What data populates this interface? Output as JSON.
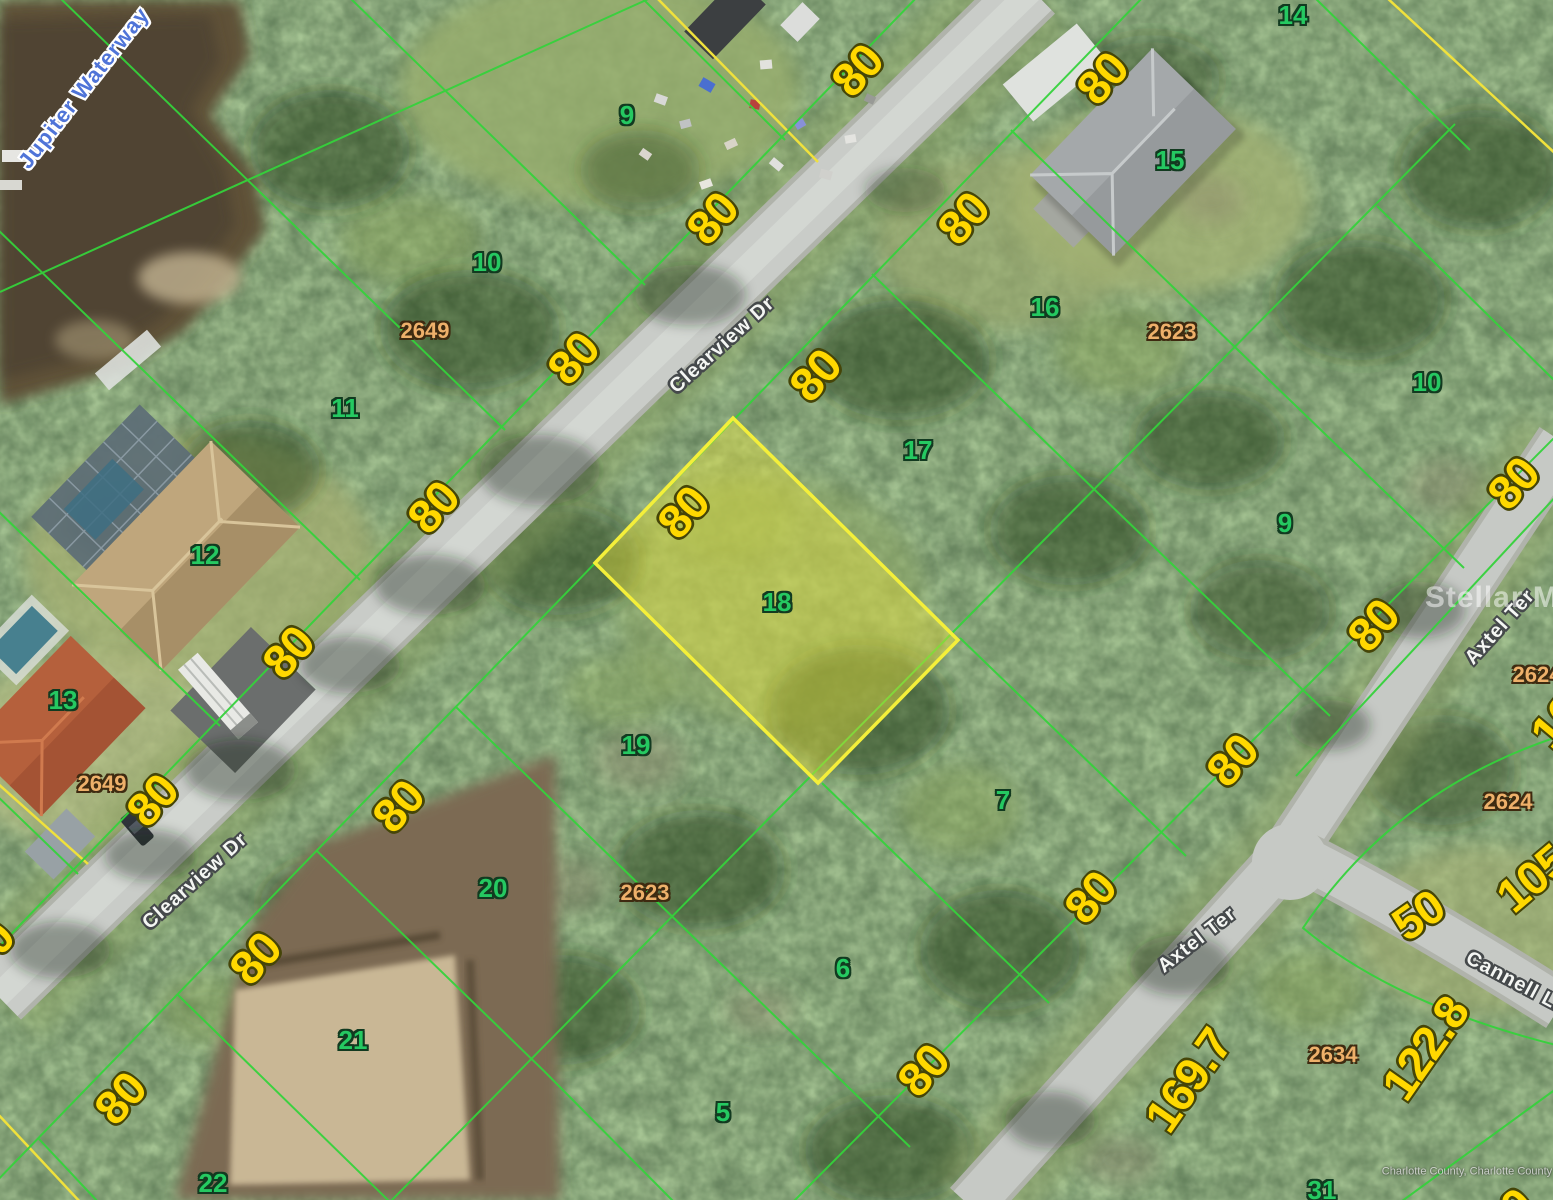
{
  "map": {
    "type": "aerial-parcel-map",
    "waterway": "Jupiter Waterway",
    "streets": [
      "Clearview Dr",
      "Axtel Ter",
      "Cannell Ln"
    ],
    "highlighted_lot": "18",
    "highlighted_lot_frontage_ft": "80",
    "lot_numbers": [
      "5",
      "6",
      "7",
      "9",
      "10",
      "11",
      "12",
      "13",
      "14",
      "15",
      "16",
      "17",
      "18",
      "19",
      "20",
      "21",
      "22",
      "31"
    ],
    "parcel_ids": [
      "2623",
      "2624",
      "2634",
      "2649"
    ],
    "dimensions_ft": [
      "80",
      "50",
      "105",
      "122.8",
      "169.7",
      "16"
    ],
    "watermark": "Stellar MLS",
    "attribution": "Charlotte County, Charlotte County GIS",
    "colors": {
      "parcel_line": "#35d23c",
      "plat_line": "#f0e13c",
      "highlight_fill": "rgba(235,228,60,0.42)",
      "highlight_stroke": "#f4ef3a",
      "dimension_text": "#ffd800",
      "lot_text": "#25c961",
      "parcel_id_text": "#eeb06a",
      "street_text": "#f2f4f3",
      "water_text": "#4f74d8"
    }
  },
  "labels": [
    {
      "cls": "water",
      "text": "Jupiter Waterway",
      "x": 84,
      "y": 88,
      "rot": -52
    },
    {
      "cls": "dim",
      "text": "80",
      "x": 857,
      "y": 70,
      "rot": -48
    },
    {
      "cls": "dim",
      "text": "80",
      "x": 1102,
      "y": 78,
      "rot": -48
    },
    {
      "cls": "dim",
      "text": "80",
      "x": 712,
      "y": 218,
      "rot": -48
    },
    {
      "cls": "dim",
      "text": "80",
      "x": 963,
      "y": 218,
      "rot": -48
    },
    {
      "cls": "dim",
      "text": "80",
      "x": 573,
      "y": 358,
      "rot": -48
    },
    {
      "cls": "dim",
      "text": "80",
      "x": 815,
      "y": 375,
      "rot": -48
    },
    {
      "cls": "dim",
      "text": "80",
      "x": 433,
      "y": 507,
      "rot": -48
    },
    {
      "cls": "dim",
      "text": "80",
      "x": 683,
      "y": 512,
      "rot": -48
    },
    {
      "cls": "dim",
      "text": "80",
      "x": 1513,
      "y": 483,
      "rot": -48
    },
    {
      "cls": "dim",
      "text": "80",
      "x": 1373,
      "y": 625,
      "rot": -48
    },
    {
      "cls": "dim",
      "text": "80",
      "x": 288,
      "y": 652,
      "rot": -48
    },
    {
      "cls": "dim",
      "text": "80",
      "x": 152,
      "y": 800,
      "rot": -48
    },
    {
      "cls": "dim",
      "text": "80",
      "x": 398,
      "y": 806,
      "rot": -48
    },
    {
      "cls": "dim",
      "text": "80",
      "x": 1232,
      "y": 760,
      "rot": -48
    },
    {
      "cls": "dim",
      "text": "80",
      "x": 255,
      "y": 958,
      "rot": -48
    },
    {
      "cls": "dim",
      "text": "80",
      "x": -12,
      "y": 947,
      "rot": -48
    },
    {
      "cls": "dim",
      "text": "80",
      "x": 120,
      "y": 1098,
      "rot": -48
    },
    {
      "cls": "dim",
      "text": "80",
      "x": 923,
      "y": 1070,
      "rot": -48
    },
    {
      "cls": "dim",
      "text": "80",
      "x": 1090,
      "y": 897,
      "rot": -48
    },
    {
      "cls": "dim",
      "text": "50",
      "x": 1418,
      "y": 915,
      "rot": -35
    },
    {
      "cls": "dim",
      "text": "105",
      "x": 1532,
      "y": 878,
      "rot": -40
    },
    {
      "cls": "dim",
      "text": "122.8",
      "x": 1425,
      "y": 1048,
      "rot": -55
    },
    {
      "cls": "dim",
      "text": "169.7",
      "x": 1188,
      "y": 1080,
      "rot": -55
    },
    {
      "cls": "dim",
      "text": "16",
      "x": 1556,
      "y": 722,
      "rot": -50
    },
    {
      "cls": "dim",
      "text": "80",
      "x": 1507,
      "y": 1214,
      "rot": -40
    },
    {
      "cls": "lot",
      "text": "9",
      "x": 627,
      "y": 115,
      "rot": 0
    },
    {
      "cls": "lot",
      "text": "10",
      "x": 487,
      "y": 262,
      "rot": 0
    },
    {
      "cls": "lot",
      "text": "11",
      "x": 345,
      "y": 408,
      "rot": 0
    },
    {
      "cls": "lot",
      "text": "12",
      "x": 205,
      "y": 555,
      "rot": 0
    },
    {
      "cls": "lot",
      "text": "13",
      "x": 63,
      "y": 700,
      "rot": 0
    },
    {
      "cls": "lot",
      "text": "14",
      "x": 1293,
      "y": 15,
      "rot": 0
    },
    {
      "cls": "lot",
      "text": "15",
      "x": 1170,
      "y": 160,
      "rot": 0
    },
    {
      "cls": "lot",
      "text": "16",
      "x": 1045,
      "y": 307,
      "rot": 0
    },
    {
      "cls": "lot",
      "text": "17",
      "x": 918,
      "y": 450,
      "rot": 0
    },
    {
      "cls": "lot",
      "text": "18",
      "x": 777,
      "y": 602,
      "rot": 0
    },
    {
      "cls": "lot",
      "text": "19",
      "x": 636,
      "y": 745,
      "rot": 0
    },
    {
      "cls": "lot",
      "text": "20",
      "x": 493,
      "y": 888,
      "rot": 0
    },
    {
      "cls": "lot",
      "text": "21",
      "x": 353,
      "y": 1040,
      "rot": 0
    },
    {
      "cls": "lot",
      "text": "22",
      "x": 213,
      "y": 1183,
      "rot": 0
    },
    {
      "cls": "lot",
      "text": "5",
      "x": 723,
      "y": 1112,
      "rot": 0
    },
    {
      "cls": "lot",
      "text": "6",
      "x": 843,
      "y": 968,
      "rot": 0
    },
    {
      "cls": "lot",
      "text": "7",
      "x": 1003,
      "y": 800,
      "rot": 0
    },
    {
      "cls": "lot",
      "text": "9",
      "x": 1285,
      "y": 523,
      "rot": 0
    },
    {
      "cls": "lot",
      "text": "10",
      "x": 1427,
      "y": 382,
      "rot": 0
    },
    {
      "cls": "lot",
      "text": "31",
      "x": 1322,
      "y": 1190,
      "rot": 0
    },
    {
      "cls": "pid",
      "text": "2649",
      "x": 425,
      "y": 331,
      "rot": 0
    },
    {
      "cls": "pid",
      "text": "2649",
      "x": 102,
      "y": 784,
      "rot": 0
    },
    {
      "cls": "pid",
      "text": "2623",
      "x": 1172,
      "y": 332,
      "rot": 0
    },
    {
      "cls": "pid",
      "text": "2623",
      "x": 645,
      "y": 893,
      "rot": 0
    },
    {
      "cls": "pid",
      "text": "2624",
      "x": 1537,
      "y": 675,
      "rot": 0
    },
    {
      "cls": "pid",
      "text": "2624",
      "x": 1508,
      "y": 802,
      "rot": 0
    },
    {
      "cls": "pid",
      "text": "2634",
      "x": 1333,
      "y": 1055,
      "rot": 0
    },
    {
      "cls": "street",
      "text": "Clearview Dr",
      "x": 722,
      "y": 345,
      "rot": -42
    },
    {
      "cls": "street",
      "text": "Clearview Dr",
      "x": 195,
      "y": 881,
      "rot": -42
    },
    {
      "cls": "street",
      "text": "Axtel Ter",
      "x": 1500,
      "y": 627,
      "rot": -48
    },
    {
      "cls": "street",
      "text": "Axtel Ter",
      "x": 1197,
      "y": 940,
      "rot": -38
    },
    {
      "cls": "street",
      "text": "Cannell Ln",
      "x": 1517,
      "y": 983,
      "rot": 28
    },
    {
      "cls": "wm",
      "text": "Stellar MLS",
      "x": 1512,
      "y": 598,
      "rot": 0
    },
    {
      "cls": "attr",
      "text": "Charlotte County, Charlotte County GIS",
      "x": 1478,
      "y": 1172,
      "rot": 0
    }
  ]
}
